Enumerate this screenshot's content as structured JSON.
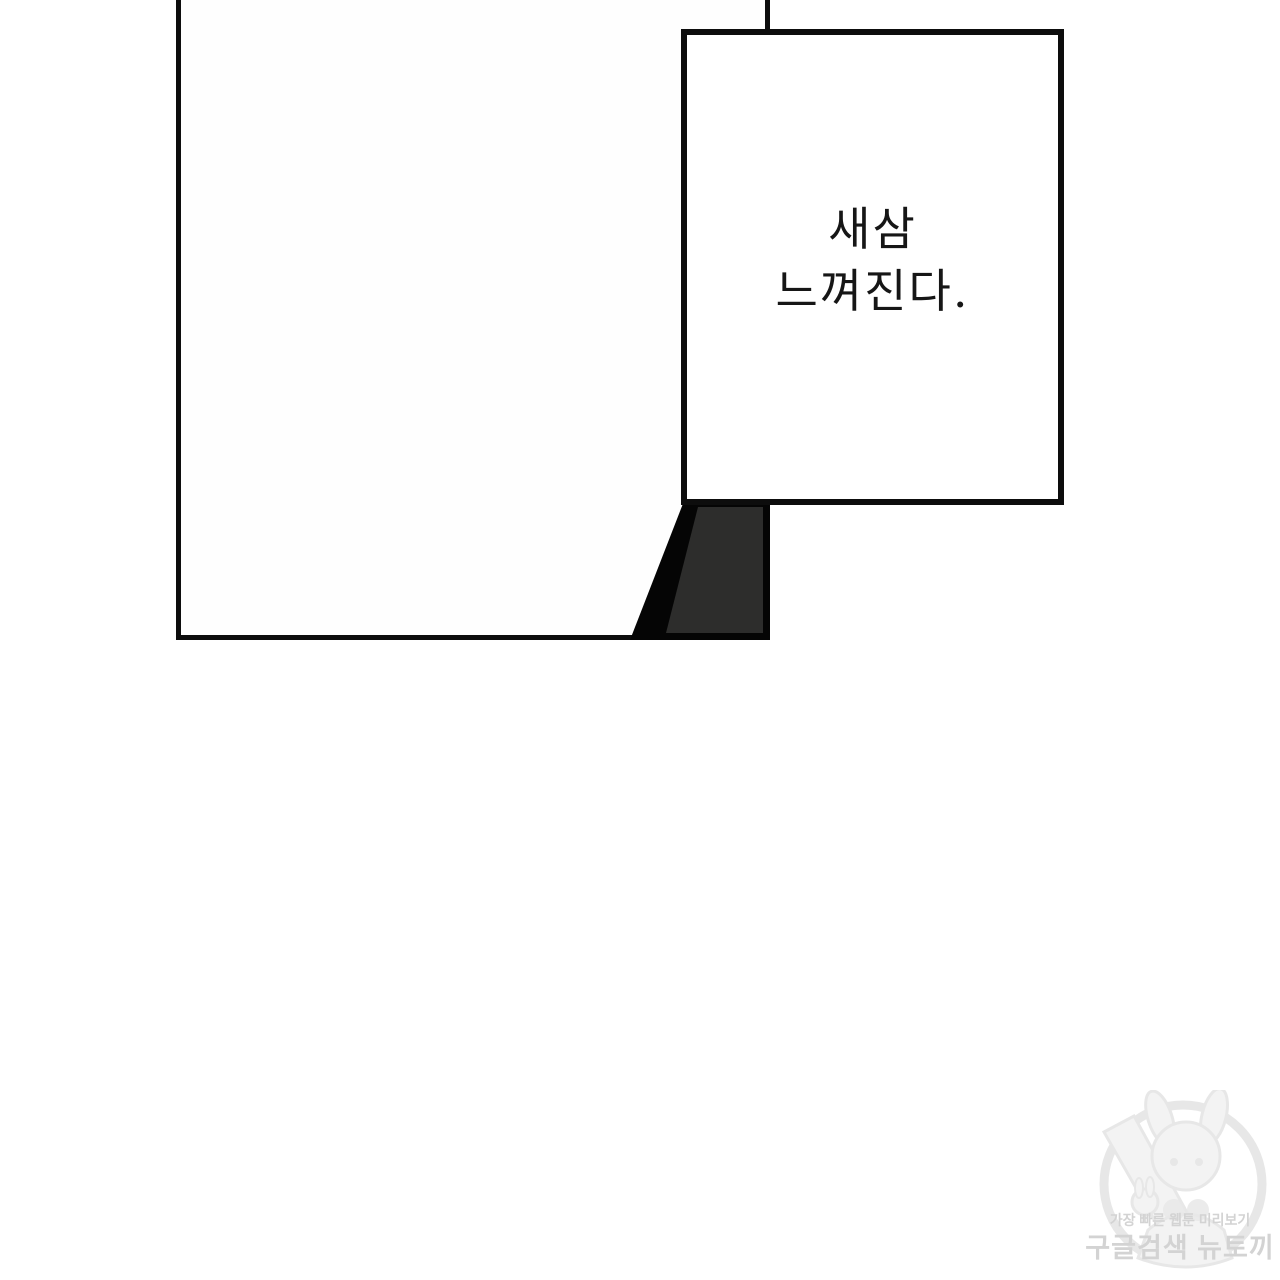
{
  "colors": {
    "ink": "#0d0d0d",
    "paper": "#ffffff",
    "panel-fill": "#fefefe",
    "shadow-fill": "#2d2d2c",
    "shadow-outline": "#050505",
    "narration-text": "#161616",
    "watermark-text": "#d3d3d3",
    "watermark-art": "#e7e7e7",
    "watermark-art-fill": "#f3f3f3"
  },
  "narration": {
    "lines": [
      "새삼",
      "느껴진다."
    ]
  },
  "watermark": {
    "subtitle": "가장 빠른 웹툰 미리보기",
    "title": "구글검색 뉴토끼",
    "mascot": "bunny-girl-with-carrot"
  }
}
